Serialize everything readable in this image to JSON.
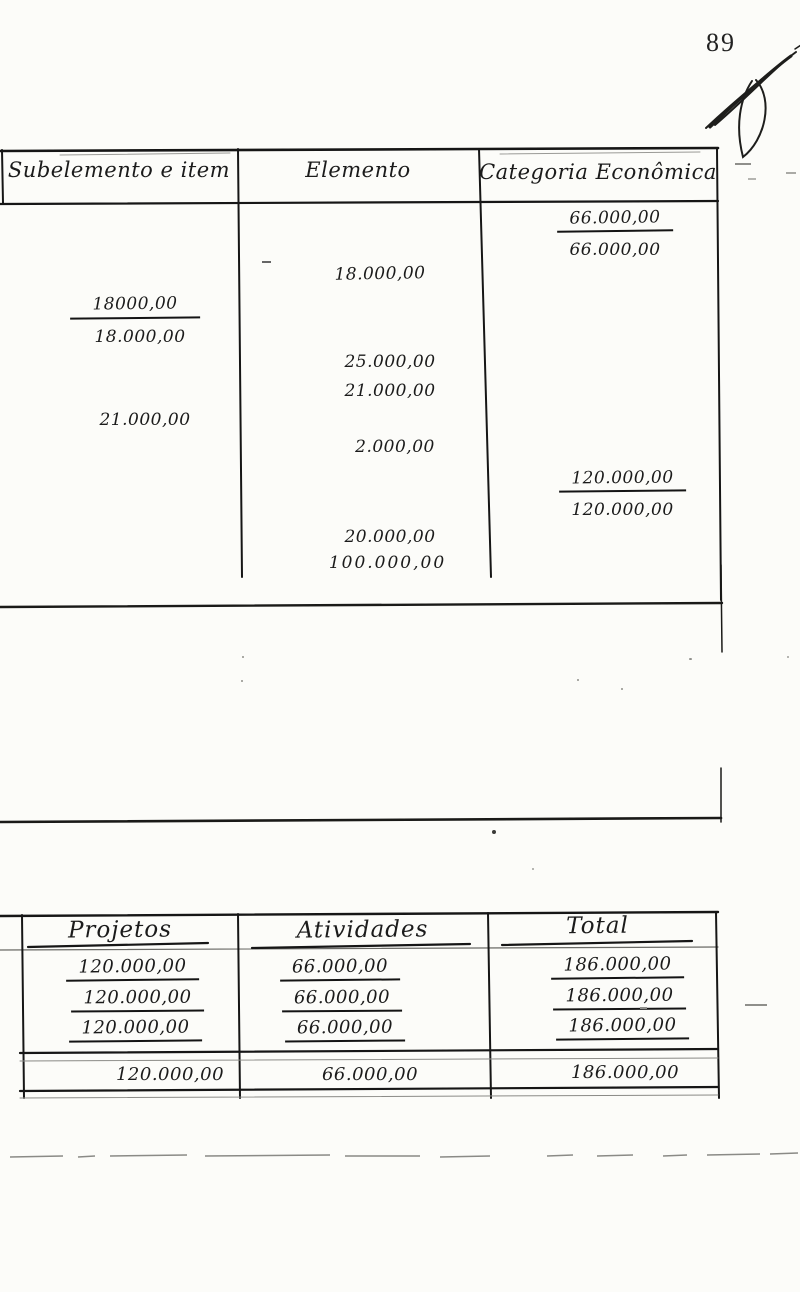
{
  "page": {
    "number": "89"
  },
  "main_table": {
    "headers": [
      "Subelemento e item",
      "Elemento",
      "Categoria Econômica"
    ],
    "entries": {
      "categoria_1_underlined": "66.000,00",
      "categoria_1_total": "66.000,00",
      "elemento_1": "18.000,00",
      "subelemento_1_underlined": "18000,00",
      "subelemento_1_total": "18.000,00",
      "elemento_2": "25.000,00",
      "elemento_3": "21.000,00",
      "subelemento_2": "21.000,00",
      "elemento_4": "2.000,00",
      "categoria_2_underlined": "120.000,00",
      "categoria_2_total": "120.000,00",
      "elemento_5": "20.000,00",
      "elemento_6": "100.000,00"
    }
  },
  "summary_table": {
    "headers": [
      "Projetos",
      "Atividades",
      "Total"
    ],
    "rows": [
      [
        "120.000,00",
        "66.000,00",
        "186.000,00"
      ],
      [
        "120.000,00",
        "66.000,00",
        "186.000,00"
      ],
      [
        "120.000,00",
        "66.000,00",
        "186.000,00"
      ]
    ],
    "totals": [
      "120.000,00",
      "66.000,00",
      "186.000,00"
    ]
  }
}
